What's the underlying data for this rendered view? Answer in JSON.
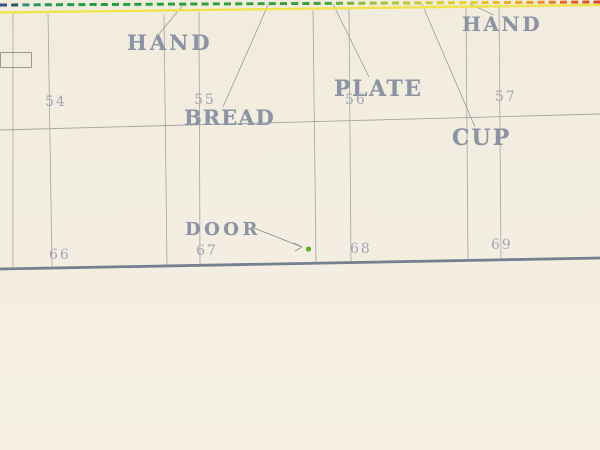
{
  "artwork": {
    "title_hint": "stencil-diagram-print",
    "colors": {
      "background": "#f3eee1",
      "word": "#8b93a5",
      "number": "#9fa7b6",
      "grid_line": "#a3a3a3",
      "diagonal_line": "#999999",
      "baseline": "#76808f",
      "rect_stroke": "#8f8f8f",
      "arrow": "#8f8f8f",
      "dot_green": "#55b61e",
      "underline_yellow": "#f0e34c"
    },
    "words": [
      {
        "text": "HAND",
        "x": 127,
        "y": 32,
        "size": 21,
        "ls": 3
      },
      {
        "text": "BREAD",
        "x": 184,
        "y": 107,
        "size": 21,
        "ls": 1
      },
      {
        "text": "PLATE",
        "x": 334,
        "y": 78,
        "size": 22,
        "ls": 1.5
      },
      {
        "text": "HAND",
        "x": 462,
        "y": 14,
        "size": 20,
        "ls": 2.5
      },
      {
        "text": "CUP",
        "x": 452,
        "y": 127,
        "size": 22,
        "ls": 2
      },
      {
        "text": "DOOR",
        "x": 185,
        "y": 221,
        "size": 18,
        "ls": 3.5
      }
    ],
    "ticks": [
      {
        "text": "54",
        "x": 45,
        "y": 95
      },
      {
        "text": "55",
        "x": 194,
        "y": 93
      },
      {
        "text": "56",
        "x": 345,
        "y": 93
      },
      {
        "text": "57",
        "x": 495,
        "y": 90
      },
      {
        "text": "66",
        "x": 49,
        "y": 248
      },
      {
        "text": "67",
        "x": 196,
        "y": 244
      },
      {
        "text": "68",
        "x": 350,
        "y": 242
      },
      {
        "text": "69",
        "x": 491,
        "y": 238
      }
    ],
    "spectrum": {
      "y_left": 5,
      "y_right": 2,
      "dash": 7,
      "gap": 4.2,
      "thickness": 3,
      "underline": {
        "y_left": 12.5,
        "y_right": 5,
        "thickness": 2.4
      },
      "stops": [
        {
          "x": 0,
          "color": "#3a66b0"
        },
        {
          "x": 10,
          "color": "#27343a"
        },
        {
          "x": 22,
          "color": "#2f8f8f"
        },
        {
          "x": 45,
          "color": "#1f9a52"
        },
        {
          "x": 70,
          "color": "#1f9e3f"
        },
        {
          "x": 320,
          "color": "#3aa437"
        },
        {
          "x": 360,
          "color": "#8ebc30"
        },
        {
          "x": 420,
          "color": "#c9cc2b"
        },
        {
          "x": 465,
          "color": "#e6d028"
        },
        {
          "x": 500,
          "color": "#efb622"
        },
        {
          "x": 535,
          "color": "#f2971c"
        },
        {
          "x": 565,
          "color": "#ec6320"
        },
        {
          "x": 600,
          "color": "#e4401f"
        }
      ]
    },
    "geometry": {
      "verticals": [
        {
          "x1": 13,
          "y1": 14,
          "x2": 13,
          "y2": 267
        },
        {
          "x1": 48,
          "y1": 14,
          "x2": 52,
          "y2": 266
        },
        {
          "x1": 164,
          "y1": 15,
          "x2": 167,
          "y2": 265
        },
        {
          "x1": 199,
          "y1": 12,
          "x2": 200,
          "y2": 264
        },
        {
          "x1": 313,
          "y1": 10,
          "x2": 316,
          "y2": 263
        },
        {
          "x1": 349,
          "y1": 8,
          "x2": 351,
          "y2": 262
        },
        {
          "x1": 466,
          "y1": 6,
          "x2": 468,
          "y2": 261
        },
        {
          "x1": 499,
          "y1": 5,
          "x2": 501,
          "y2": 259
        }
      ],
      "horizontals": [
        {
          "x1": 0,
          "y1": 130,
          "x2": 600,
          "y2": 114,
          "w": 0.9
        }
      ],
      "baseline": {
        "x1": 0,
        "y1": 269,
        "x2": 600,
        "y2": 258,
        "w": 2.8
      },
      "diagonals": [
        {
          "x1": 183,
          "y1": 5,
          "x2": 159,
          "y2": 34
        },
        {
          "x1": 268,
          "y1": 5,
          "x2": 223,
          "y2": 107
        },
        {
          "x1": 333,
          "y1": 4,
          "x2": 369,
          "y2": 77
        },
        {
          "x1": 422,
          "y1": 4,
          "x2": 475,
          "y2": 127
        },
        {
          "x1": 470,
          "y1": 4,
          "x2": 494,
          "y2": 15
        }
      ],
      "rect": {
        "x": 0,
        "y": 52,
        "w": 31,
        "h": 15
      },
      "arrow": {
        "x1": 254,
        "y1": 228,
        "x2": 302,
        "y2": 247,
        "head": "294,243 302,247 295,251"
      },
      "dot": {
        "cx": 308.5,
        "cy": 249,
        "r": 2.6
      }
    }
  }
}
